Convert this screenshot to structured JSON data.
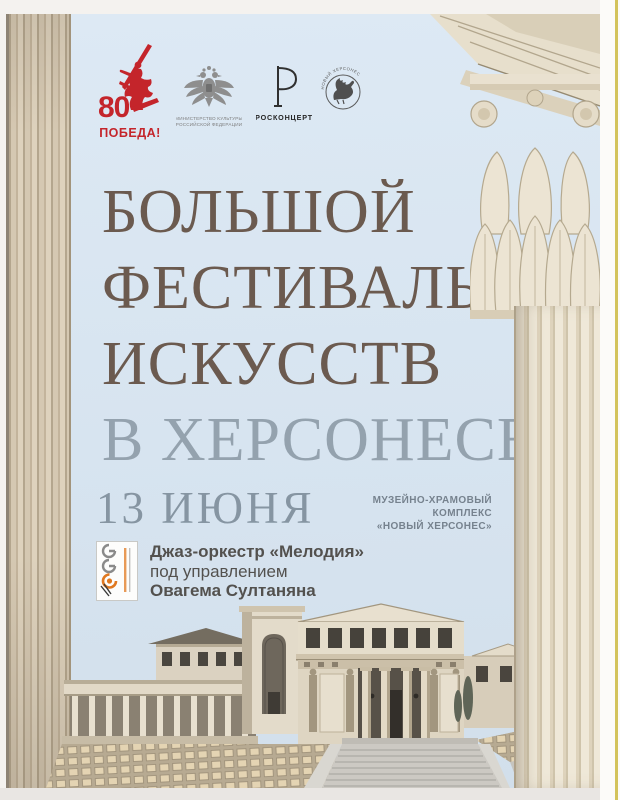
{
  "page": {
    "background": "#f4f2ef",
    "bottom_strip_color": "#e9e6e3",
    "right_accent_line_color": "#d3c35c"
  },
  "poster": {
    "sky_color": "#d7e4f0",
    "partners": {
      "victory80": {
        "number": "80",
        "label": "ПОБЕДА!",
        "color": "#c4252b",
        "icon": "motherland-calls-statue"
      },
      "ministry": {
        "line1": "МИНИСТЕРСТВО КУЛЬТУРЫ",
        "line2": "РОССИЙСКОЙ ФЕДЕРАЦИИ",
        "icon": "double-headed-eagle"
      },
      "rosconcert": {
        "label": "РОСКОНЦЕРТ",
        "icon": "r-monogram"
      },
      "new_chersonese": {
        "label": "НОВЫЙ ХЕРСОНЕС",
        "icon": "griffin-emblem"
      }
    },
    "title": {
      "line1": "БОЛЬШОЙ",
      "line2": "ФЕСТИВАЛЬ",
      "line3": "ИСКУССТВ",
      "line4": "В ХЕРСОНЕСЕ",
      "main_color": "#6b5a4f",
      "accent_color": "#94a2ae"
    },
    "date": "13 ИЮНЯ",
    "venue": {
      "line1": "МУЗЕЙНО-ХРАМОВЫЙ",
      "line2": "КОМПЛЕКС",
      "line3": "«НОВЫЙ ХЕРСОНЕС»"
    },
    "program": {
      "orchestra": "Джаз-оркестр «Мелодия»",
      "conductor_intro": "под управлением",
      "conductor": "Овагема Султаняна"
    }
  }
}
